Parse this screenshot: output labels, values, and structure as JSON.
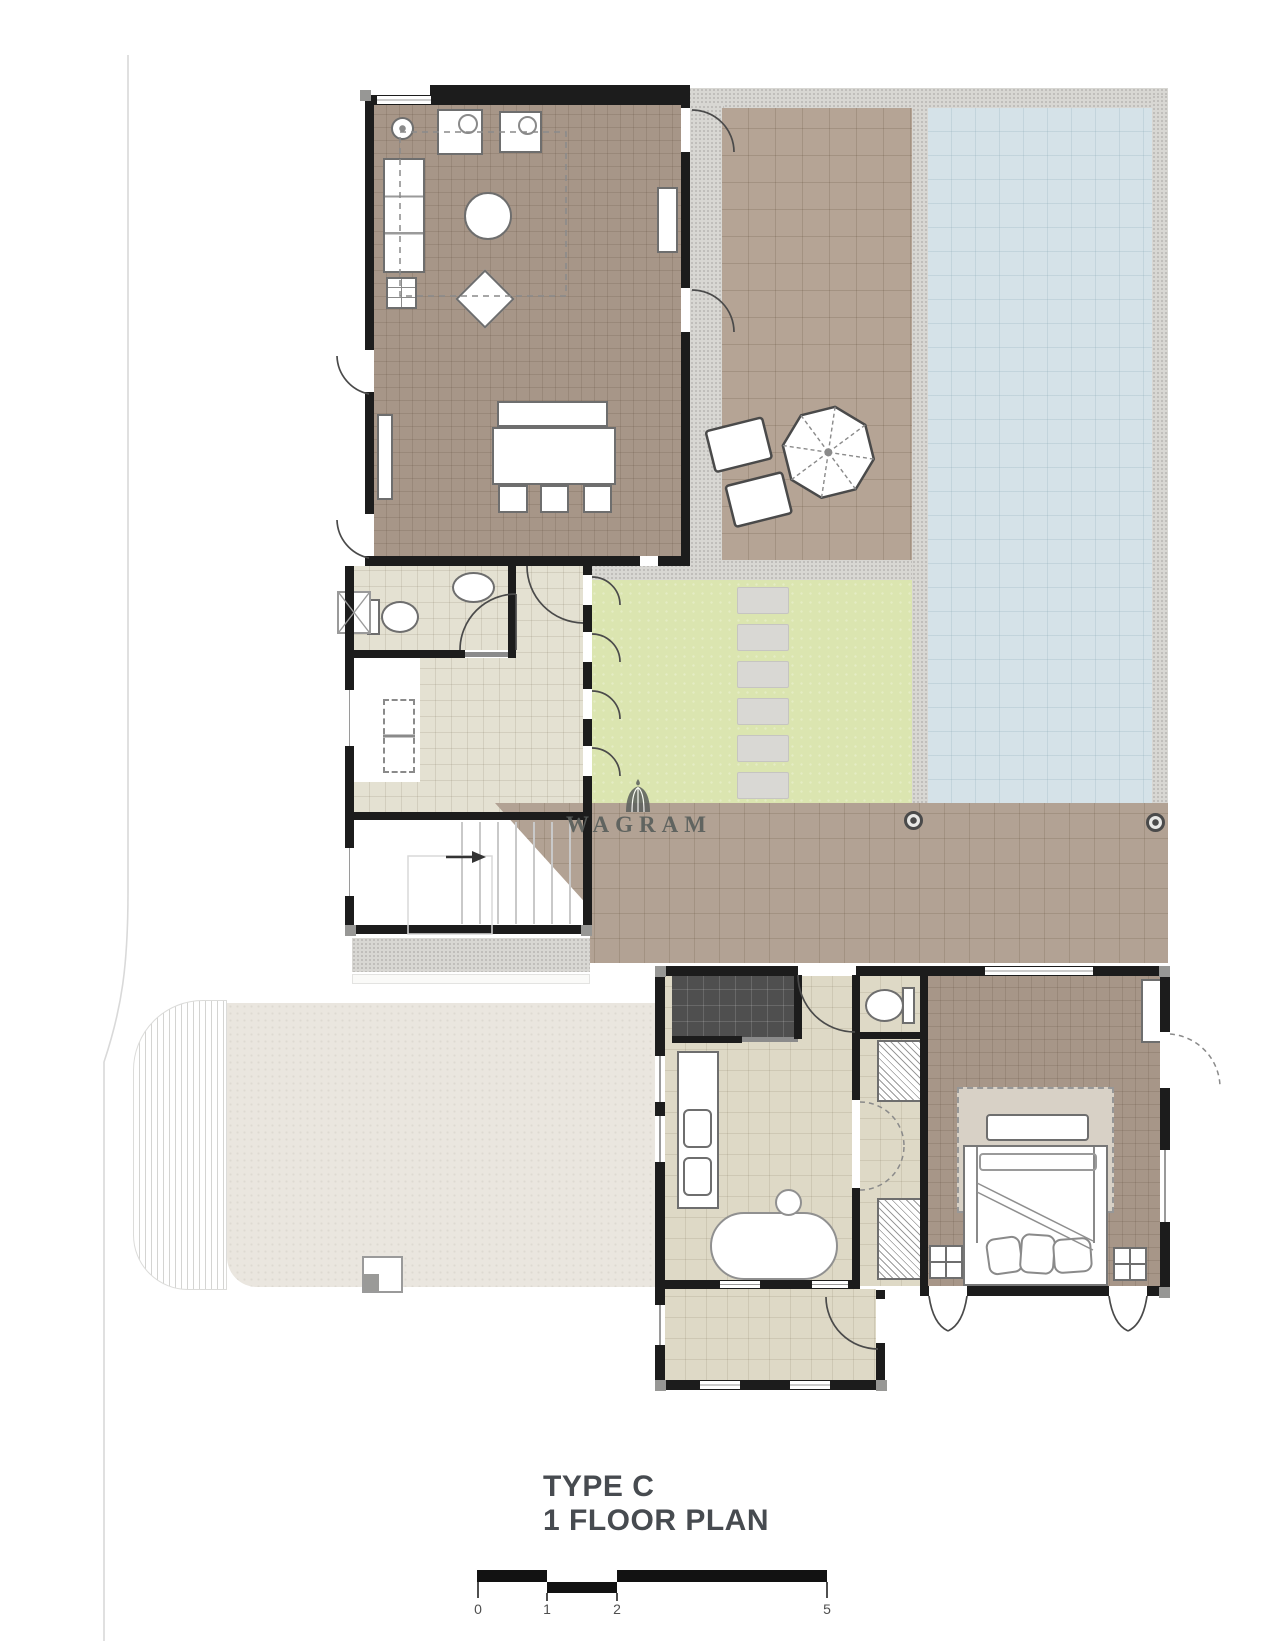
{
  "document": {
    "kind": "architectural floor plan drawing"
  },
  "title": {
    "line1": "TYPE C",
    "line2": "1 FLOOR PLAN"
  },
  "watermark": {
    "name": "WAGRAM",
    "icon": "dome-icon"
  },
  "scale_bar": {
    "labels": [
      "0",
      "1",
      "2",
      "5"
    ]
  },
  "colors": {
    "wall": "#1c1c1c",
    "floor_taupe": "#a79688",
    "terrace_deck": "#b5a495",
    "deck_band": "#b2a294",
    "pool_water": "#d5e2e8",
    "pool_rim_concrete": "#d8d7d3",
    "lawn_green": "#dbe5b0",
    "tile_cream": "#e4e1d2",
    "tile_beige": "#ded9c6",
    "driveway_beige": "#eae6df",
    "shower_dark": "#4f4f4f",
    "rug": "#d8d1c6",
    "stepping_stone": "#d9d8d4",
    "watermark_gray": "#5a5f5c",
    "title_gray": "#474b50"
  }
}
